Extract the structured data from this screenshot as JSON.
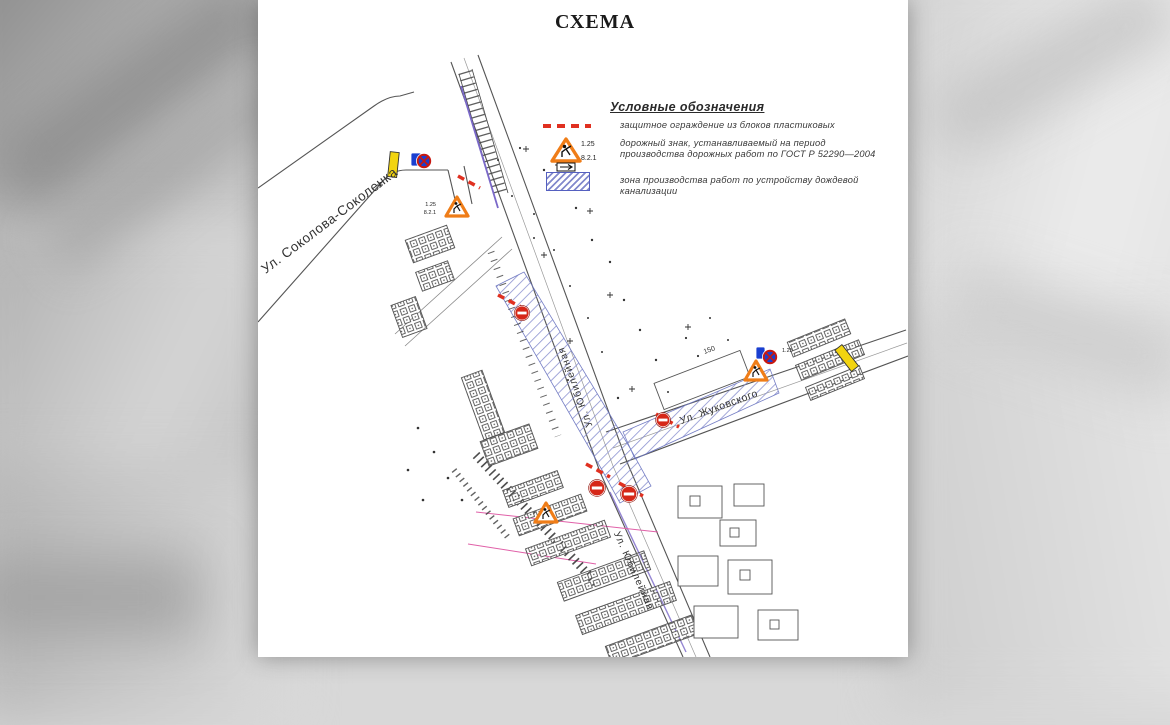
{
  "document": {
    "title": "СХЕМА"
  },
  "legend": {
    "title": "Условные обозначения",
    "items": [
      {
        "symbol": "red-dashed-barrier",
        "label": "защитное ограждение из блоков пластиковых"
      },
      {
        "symbol": "roadworks-sign",
        "sign_code": "1.25",
        "plate_code": "8.2.1",
        "label_line1": "дорожный знак, устанавливаемый на период",
        "label_line2": "производства дорожных работ по ГОСТ Р 52290—2004"
      },
      {
        "symbol": "hatched-work-zone",
        "label": "зона производства работ по устройству дождевой канализации"
      }
    ]
  },
  "map": {
    "streets": {
      "sokolova": "Ул. Соколова-Соколенка",
      "yubileynaya": "Ул. Юбилейная",
      "zhukovskogo": "Ул. Жуковского"
    },
    "signs": {
      "roadworks_code": "1.25",
      "plate_code": "8.2.1"
    },
    "dimensions": {
      "d150": "150"
    }
  },
  "colors": {
    "barrier_red": "#e03020",
    "zone_hatch_blue": "#8289cc",
    "warning_orange": "#ef7d18",
    "sign_blue": "#1a3fd0",
    "sign_yellow": "#f2d410"
  }
}
